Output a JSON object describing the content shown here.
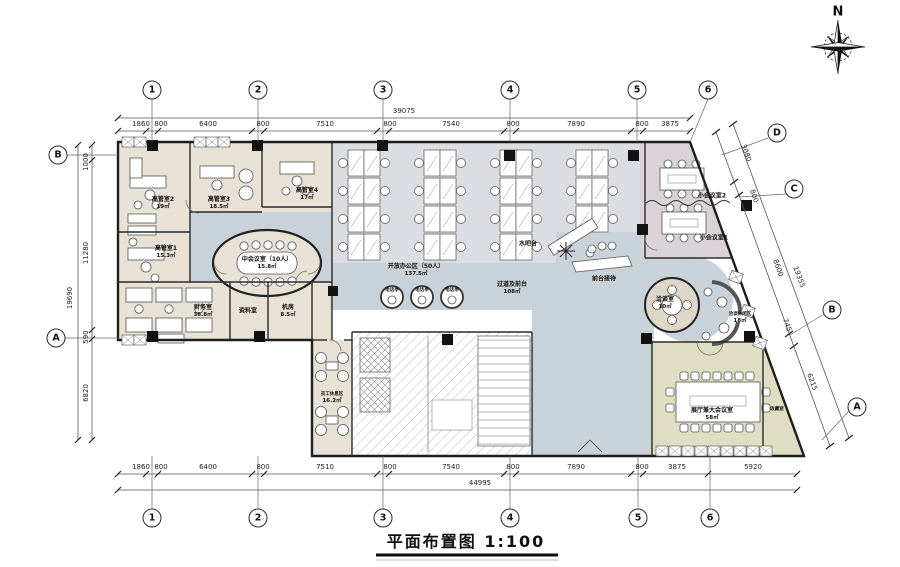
{
  "title": {
    "text": "平面布置图 1:100"
  },
  "compass": {
    "label": "N"
  },
  "grid_bubbles": {
    "top": [
      "1",
      "2",
      "3",
      "4",
      "5",
      "6"
    ],
    "bottom": [
      "1",
      "2",
      "3",
      "4",
      "5",
      "6"
    ],
    "left": [
      "B",
      "A"
    ],
    "right": [
      "D",
      "C",
      "B",
      "A"
    ]
  },
  "dimensions": {
    "top": {
      "segments": [
        "1860",
        "800",
        "6400",
        "800",
        "7510",
        "800",
        "7540",
        "800",
        "7890",
        "800",
        "3875"
      ],
      "total": "39075"
    },
    "bottom": {
      "segments": [
        "1860",
        "800",
        "6400",
        "800",
        "7510",
        "800",
        "7540",
        "800",
        "7890",
        "800",
        "3875",
        "5920"
      ],
      "total": "44995"
    },
    "left": {
      "segments": [
        "1000",
        "11280",
        "590",
        "6820"
      ],
      "total": "19690"
    },
    "right": {
      "segments": [
        "3080",
        "800",
        "8600",
        "745",
        "6215"
      ],
      "total": "19355"
    }
  },
  "rooms": {
    "exec2": {
      "name": "高管室2",
      "area": "19㎡"
    },
    "exec1": {
      "name": "高管室1",
      "area": "15.3㎡"
    },
    "exec3": {
      "name": "高管室3",
      "area": "18.5㎡"
    },
    "exec4": {
      "name": "高管室4",
      "area": "17㎡"
    },
    "mid_meeting": {
      "name": "中会议室（10人）",
      "area": "15.8㎡"
    },
    "finance": {
      "name": "财务室",
      "area": "36.8㎡"
    },
    "archive": {
      "name": "资料室"
    },
    "server": {
      "name": "机房",
      "area": "8.5㎡"
    },
    "open_office": {
      "name": "开放办公区（50人）",
      "area": "137.5㎡"
    },
    "water_bar": {
      "name": "水吧台"
    },
    "corridor": {
      "name": "过道及前台",
      "area": "108㎡"
    },
    "reception": {
      "name": "前台接待"
    },
    "small_meeting2": {
      "name": "小会议室2"
    },
    "small_meeting1": {
      "name": "小会议室1"
    },
    "negotiation": {
      "name": "洽谈室",
      "area": "10㎡"
    },
    "lounge": {
      "name": "洽谈休闲区",
      "area": "18㎡"
    },
    "staff_rest": {
      "name": "员工休息区",
      "area": "16.2㎡"
    },
    "exhibition": {
      "name": "展厅兼大会议室",
      "area": "58㎡"
    },
    "storage": {
      "name": "收藏室"
    },
    "phone_booth": {
      "name": "电话亭"
    }
  },
  "colors": {
    "left_rooms": "#e7e1d6",
    "open_office": "#dcdde3",
    "meeting_zone": "#d9d2d7",
    "corridor": "#c9d2d9",
    "exhibition": "#dfddc3",
    "round_room": "#ded6c8",
    "wall": "#1e1e1e"
  }
}
